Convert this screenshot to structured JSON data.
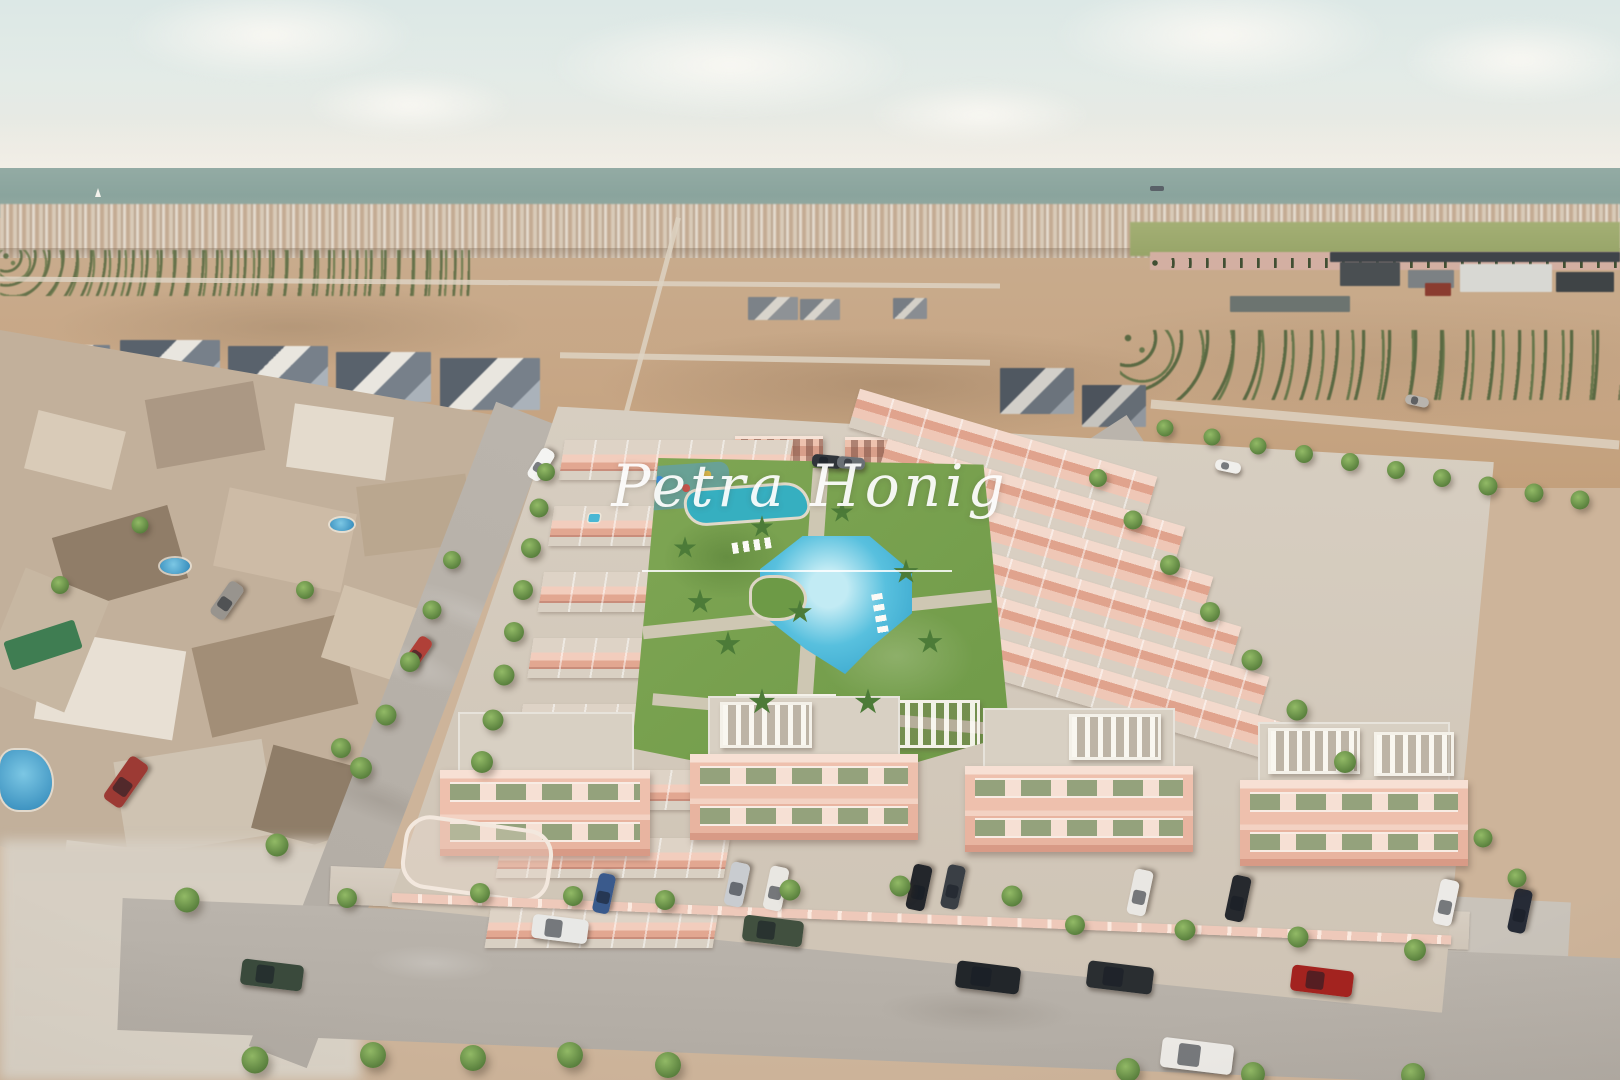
{
  "watermark": {
    "text": "Petra Honig"
  },
  "palette": {
    "sky": "#dfe8e6",
    "sea": "#8aa49d",
    "distant_town": "#cdbbaa",
    "farmland": "#c7a685",
    "bare_field": "#a06f4e",
    "sand": "#cdb8a4",
    "building_pink": "#eec0ad",
    "terrace_grey": "#d8d0c3",
    "shutter_green": "#94a27c",
    "pool_blue": "#3fb3d9",
    "grass_green": "#7fa654",
    "road_grey": "#b7b1a9"
  },
  "trees": [
    {
      "x": 546,
      "y": 472,
      "s": 0.9
    },
    {
      "x": 539,
      "y": 508,
      "s": 0.95
    },
    {
      "x": 531,
      "y": 548,
      "s": 1
    },
    {
      "x": 523,
      "y": 590,
      "s": 1
    },
    {
      "x": 514,
      "y": 632,
      "s": 1
    },
    {
      "x": 504,
      "y": 675,
      "s": 1.05
    },
    {
      "x": 493,
      "y": 720,
      "s": 1.05
    },
    {
      "x": 482,
      "y": 762,
      "s": 1.1
    },
    {
      "x": 452,
      "y": 560,
      "s": 0.9
    },
    {
      "x": 432,
      "y": 610,
      "s": 0.95
    },
    {
      "x": 410,
      "y": 662,
      "s": 1
    },
    {
      "x": 386,
      "y": 715,
      "s": 1.05
    },
    {
      "x": 361,
      "y": 768,
      "s": 1.1
    },
    {
      "x": 341,
      "y": 748,
      "s": 1
    },
    {
      "x": 277,
      "y": 845,
      "s": 1.15
    },
    {
      "x": 187,
      "y": 900,
      "s": 1.25
    },
    {
      "x": 60,
      "y": 585,
      "s": 0.9
    },
    {
      "x": 140,
      "y": 525,
      "s": 0.85
    },
    {
      "x": 305,
      "y": 590,
      "s": 0.9
    },
    {
      "x": 347,
      "y": 898,
      "s": 1
    },
    {
      "x": 480,
      "y": 893,
      "s": 1
    },
    {
      "x": 573,
      "y": 896,
      "s": 1
    },
    {
      "x": 665,
      "y": 900,
      "s": 1
    },
    {
      "x": 790,
      "y": 890,
      "s": 1.05
    },
    {
      "x": 900,
      "y": 886,
      "s": 1.05
    },
    {
      "x": 1012,
      "y": 896,
      "s": 1.05
    },
    {
      "x": 1075,
      "y": 925,
      "s": 1
    },
    {
      "x": 1185,
      "y": 930,
      "s": 1.05
    },
    {
      "x": 1298,
      "y": 937,
      "s": 1.05
    },
    {
      "x": 1415,
      "y": 950,
      "s": 1.1
    },
    {
      "x": 1483,
      "y": 838,
      "s": 0.95
    },
    {
      "x": 1517,
      "y": 878,
      "s": 0.95
    },
    {
      "x": 255,
      "y": 1060,
      "s": 1.35
    },
    {
      "x": 373,
      "y": 1055,
      "s": 1.3
    },
    {
      "x": 473,
      "y": 1058,
      "s": 1.3
    },
    {
      "x": 570,
      "y": 1055,
      "s": 1.3
    },
    {
      "x": 668,
      "y": 1065,
      "s": 1.3
    },
    {
      "x": 1128,
      "y": 1070,
      "s": 1.2
    },
    {
      "x": 1253,
      "y": 1074,
      "s": 1.2
    },
    {
      "x": 1413,
      "y": 1075,
      "s": 1.2
    },
    {
      "x": 1098,
      "y": 478,
      "s": 0.9
    },
    {
      "x": 1133,
      "y": 520,
      "s": 0.95
    },
    {
      "x": 1170,
      "y": 565,
      "s": 1
    },
    {
      "x": 1210,
      "y": 612,
      "s": 1
    },
    {
      "x": 1252,
      "y": 660,
      "s": 1.05
    },
    {
      "x": 1297,
      "y": 710,
      "s": 1.05
    },
    {
      "x": 1345,
      "y": 762,
      "s": 1.1
    },
    {
      "x": 1165,
      "y": 428,
      "s": 0.85
    },
    {
      "x": 1212,
      "y": 437,
      "s": 0.85
    },
    {
      "x": 1258,
      "y": 446,
      "s": 0.85
    },
    {
      "x": 1304,
      "y": 454,
      "s": 0.9
    },
    {
      "x": 1350,
      "y": 462,
      "s": 0.9
    },
    {
      "x": 1396,
      "y": 470,
      "s": 0.9
    },
    {
      "x": 1442,
      "y": 478,
      "s": 0.9
    },
    {
      "x": 1488,
      "y": 486,
      "s": 0.95
    },
    {
      "x": 1534,
      "y": 493,
      "s": 0.95
    },
    {
      "x": 1580,
      "y": 500,
      "s": 0.95
    },
    {
      "x": 700,
      "y": 602,
      "s": 1,
      "t": "palm"
    },
    {
      "x": 728,
      "y": 644,
      "s": 1,
      "t": "palm"
    },
    {
      "x": 762,
      "y": 527,
      "s": 0.9,
      "t": "palm"
    },
    {
      "x": 842,
      "y": 512,
      "s": 0.9,
      "t": "palm"
    },
    {
      "x": 906,
      "y": 572,
      "s": 1,
      "t": "palm"
    },
    {
      "x": 930,
      "y": 642,
      "s": 1,
      "t": "palm"
    },
    {
      "x": 868,
      "y": 702,
      "s": 1.05,
      "t": "palm"
    },
    {
      "x": 762,
      "y": 702,
      "s": 1.05,
      "t": "palm"
    },
    {
      "x": 685,
      "y": 548,
      "s": 0.9,
      "t": "palm"
    },
    {
      "x": 800,
      "y": 612,
      "s": 0.95,
      "t": "palm"
    }
  ],
  "cars": [
    {
      "x": 272,
      "y": 975,
      "l": 62,
      "w": 26,
      "c": "#3a4a3c",
      "r": 7
    },
    {
      "x": 560,
      "y": 929,
      "l": 56,
      "w": 24,
      "c": "#e8e8e6",
      "r": 7
    },
    {
      "x": 773,
      "y": 931,
      "l": 60,
      "w": 26,
      "c": "#41503f",
      "r": 7
    },
    {
      "x": 988,
      "y": 977,
      "l": 64,
      "w": 27,
      "c": "#22262a",
      "r": 7
    },
    {
      "x": 1120,
      "y": 977,
      "l": 66,
      "w": 27,
      "c": "#2a2e31",
      "r": 7
    },
    {
      "x": 1322,
      "y": 981,
      "l": 62,
      "w": 26,
      "c": "#a3231f",
      "r": 7
    },
    {
      "x": 1197,
      "y": 1056,
      "l": 72,
      "w": 30,
      "c": "#eceae6",
      "r": 7
    },
    {
      "x": 737,
      "y": 884,
      "l": 44,
      "w": 19,
      "c": "#c9ccd0",
      "r": -78
    },
    {
      "x": 776,
      "y": 888,
      "l": 44,
      "w": 19,
      "c": "#e9e7e2",
      "r": -78
    },
    {
      "x": 919,
      "y": 887,
      "l": 46,
      "w": 19,
      "c": "#23262b",
      "r": -78
    },
    {
      "x": 953,
      "y": 887,
      "l": 44,
      "w": 18,
      "c": "#3a3f45",
      "r": -78
    },
    {
      "x": 604,
      "y": 893,
      "l": 40,
      "w": 17,
      "c": "#3a5a8c",
      "r": -78
    },
    {
      "x": 1140,
      "y": 892,
      "l": 46,
      "w": 19,
      "c": "#e9e7e3",
      "r": -78
    },
    {
      "x": 1238,
      "y": 898,
      "l": 46,
      "w": 19,
      "c": "#26292e",
      "r": -78
    },
    {
      "x": 1446,
      "y": 902,
      "l": 46,
      "w": 19,
      "c": "#eceae7",
      "r": -78
    },
    {
      "x": 1520,
      "y": 911,
      "l": 44,
      "w": 18,
      "c": "#262b36",
      "r": -78
    },
    {
      "x": 227,
      "y": 600,
      "l": 40,
      "w": 17,
      "c": "#98948e",
      "r": -55
    },
    {
      "x": 418,
      "y": 652,
      "l": 34,
      "w": 15,
      "c": "#b04038",
      "r": -55
    },
    {
      "x": 126,
      "y": 782,
      "l": 52,
      "w": 22,
      "c": "#9c3a34",
      "r": -55
    },
    {
      "x": 827,
      "y": 461,
      "l": 30,
      "w": 13,
      "c": "#30353b",
      "r": 5
    },
    {
      "x": 851,
      "y": 463,
      "l": 28,
      "w": 12,
      "c": "#6a7076",
      "r": 5
    },
    {
      "x": 541,
      "y": 464,
      "l": 34,
      "w": 15,
      "c": "#f4f4f2",
      "r": -58
    },
    {
      "x": 1228,
      "y": 466,
      "l": 26,
      "w": 11,
      "c": "#f0efec",
      "r": 12
    },
    {
      "x": 1417,
      "y": 401,
      "l": 24,
      "w": 10,
      "c": "#b8b4ae",
      "r": 12
    }
  ]
}
